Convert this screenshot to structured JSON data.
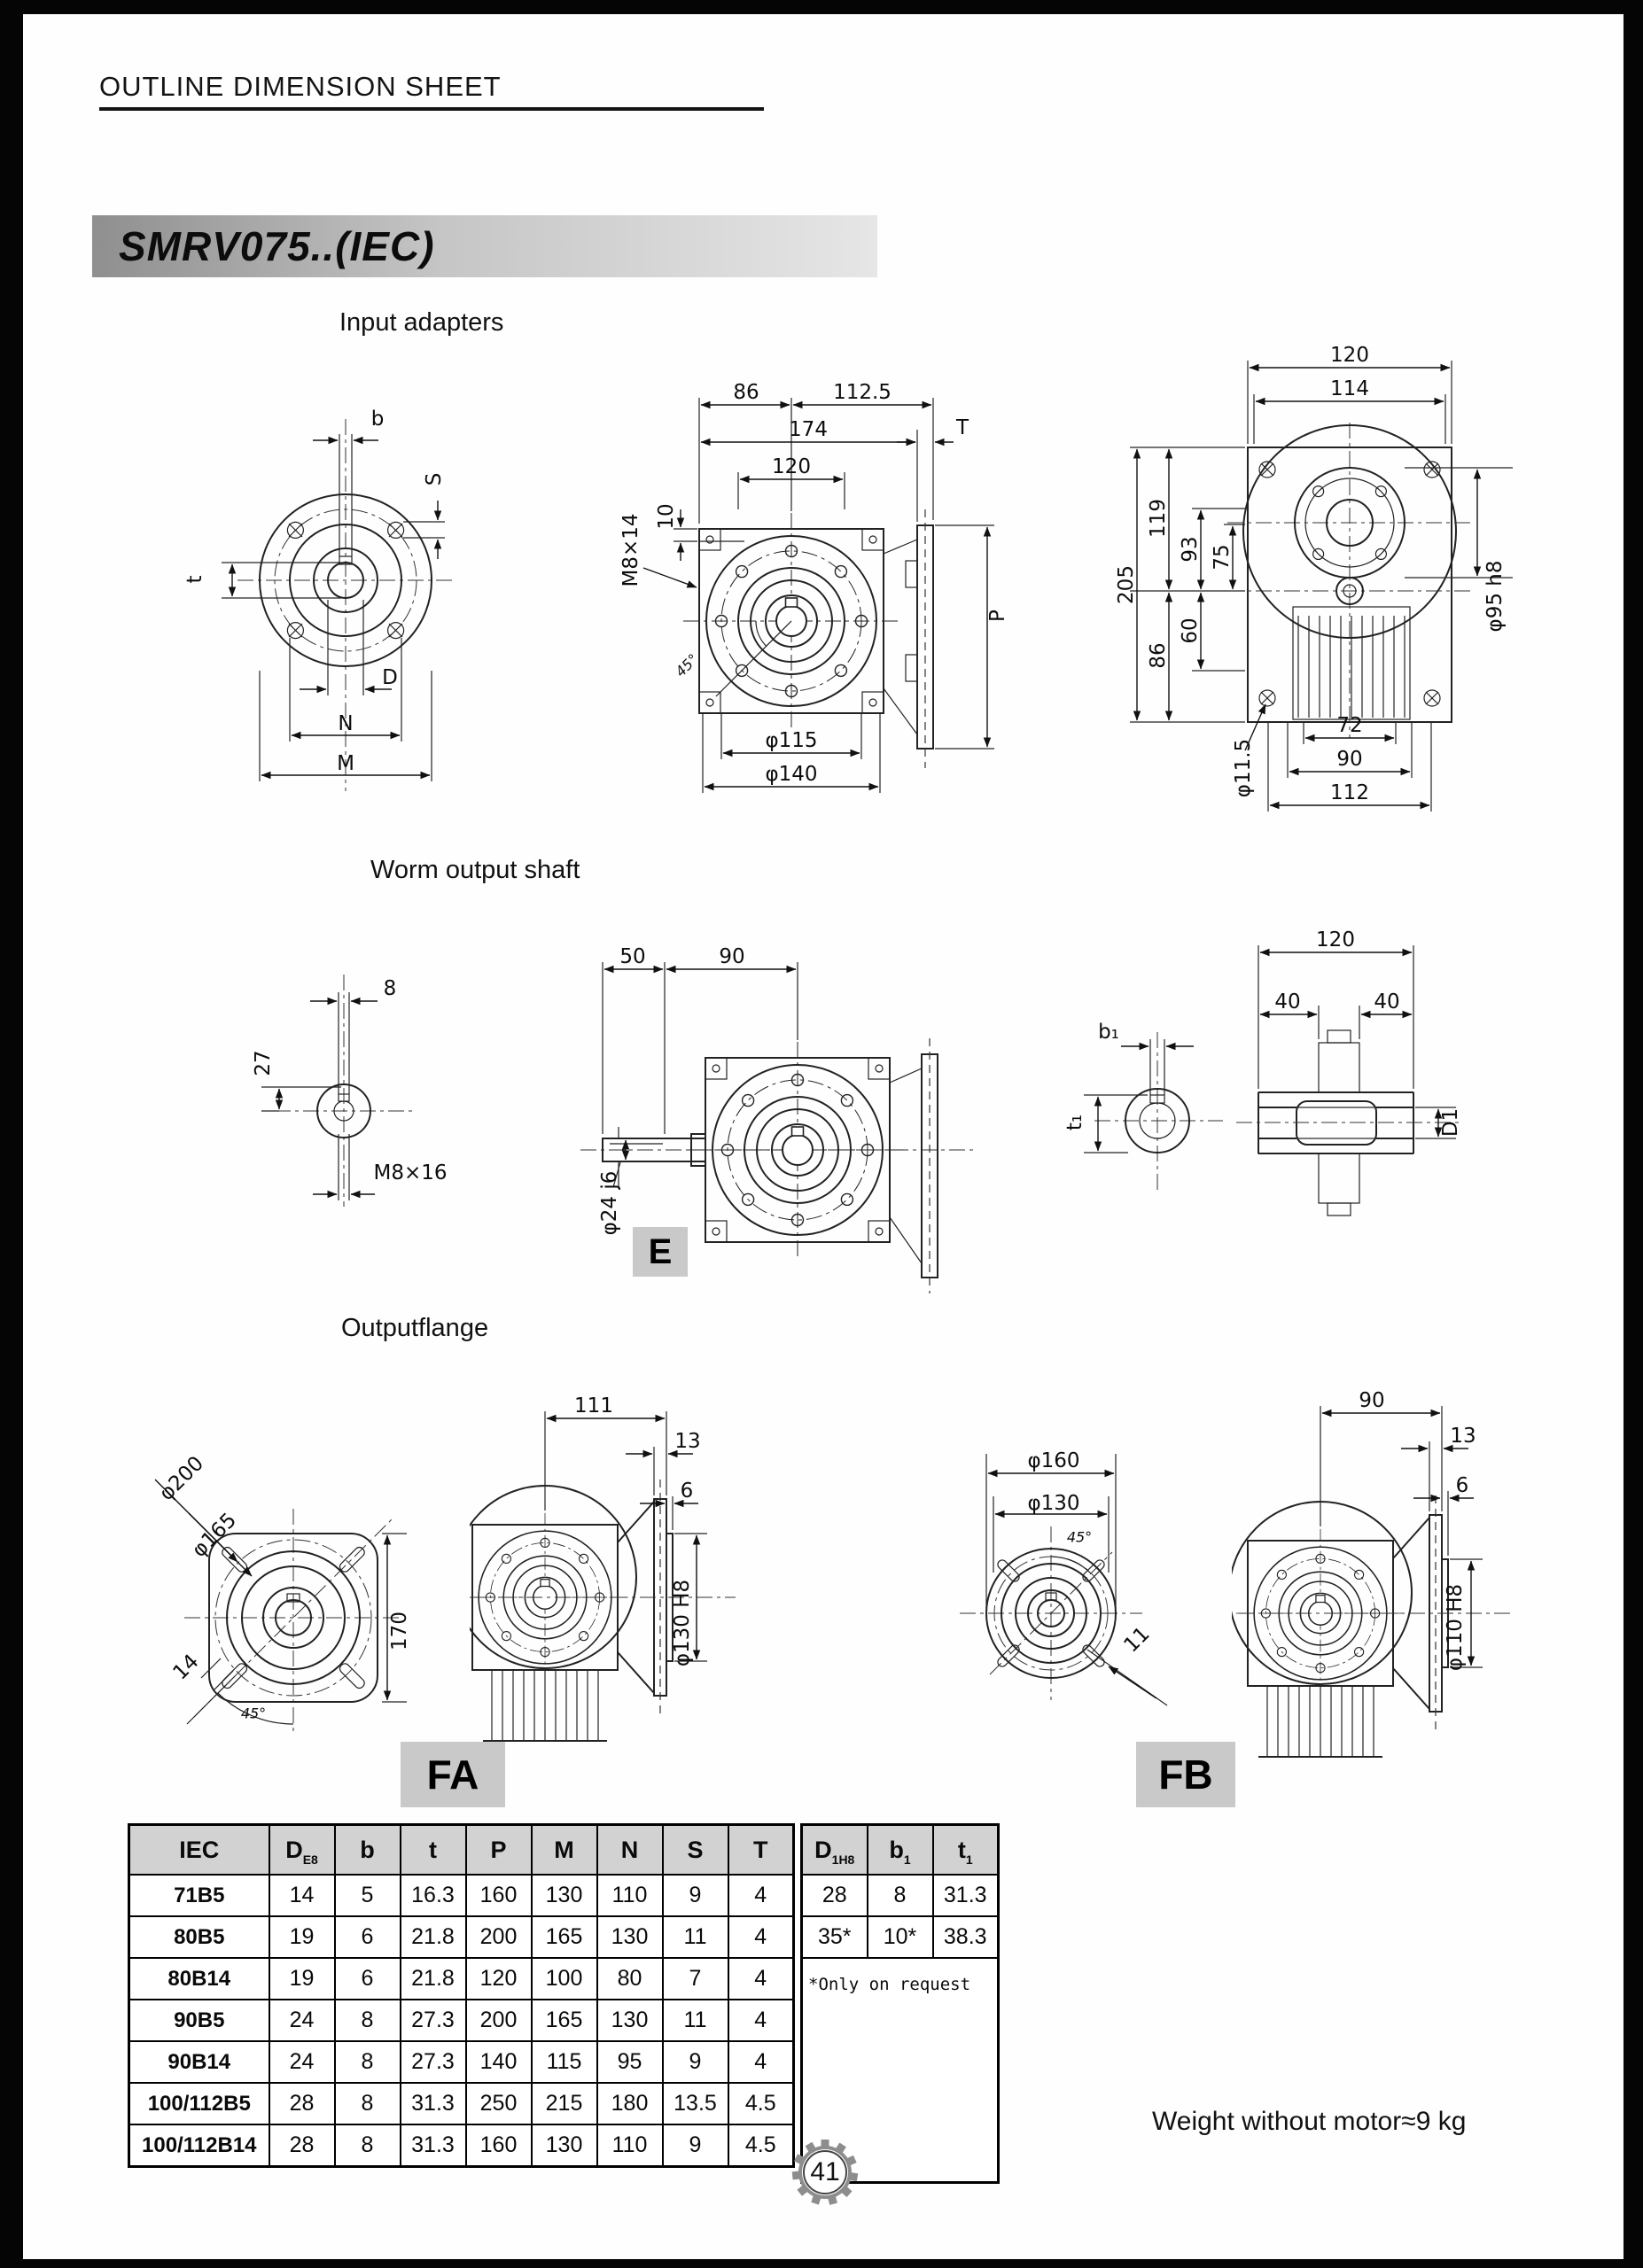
{
  "page": {
    "header": "OUTLINE DIMENSION SHEET",
    "title": "SMRV075..(IEC)",
    "page_number": "41",
    "weight_note": "Weight without motor≈9 kg"
  },
  "colors": {
    "badge_bg": "#c9c9c9",
    "titlebar_left": "#8f8f8f",
    "titlebar_right": "#e6e6e6",
    "table_header_bg": "#d2d2d2"
  },
  "sections": {
    "input_adapters": "Input adapters",
    "worm_output_shaft": "Worm output shaft",
    "output_flange": "Outputflange"
  },
  "badges": {
    "e": "E",
    "fa": "FA",
    "fb": "FB"
  },
  "dims": {
    "ia_front": [
      "b",
      "S",
      "t",
      "D",
      "N",
      "M"
    ],
    "ia_side": [
      "86",
      "112.5",
      "174",
      "T",
      "120",
      "10",
      "M8×14",
      "P",
      "45°",
      "φ115",
      "φ140"
    ],
    "ia_back": [
      "120",
      "114",
      "205",
      "119",
      "93",
      "75",
      "86",
      "60",
      "φ95 h8",
      "φ11.5",
      "72",
      "90",
      "112"
    ],
    "ws_end": [
      "8",
      "27",
      "M8×16"
    ],
    "ws_side": [
      "50",
      "90",
      "φ24 j6"
    ],
    "ws_bush": [
      "b₁",
      "t₁",
      "120",
      "40",
      "40",
      "D1"
    ],
    "fa_front": [
      "φ200",
      "φ165",
      "170",
      "14",
      "45°"
    ],
    "fa_side": [
      "111",
      "13",
      "6",
      "φ130 H8"
    ],
    "fb_front": [
      "φ160",
      "φ130",
      "45°",
      "11"
    ],
    "fb_side": [
      "90",
      "13",
      "6",
      "φ110 H8"
    ]
  },
  "table": {
    "headers": [
      {
        "t": "IEC",
        "s": ""
      },
      {
        "t": "D",
        "s": "E8"
      },
      {
        "t": "b",
        "s": ""
      },
      {
        "t": "t",
        "s": ""
      },
      {
        "t": "P",
        "s": ""
      },
      {
        "t": "M",
        "s": ""
      },
      {
        "t": "N",
        "s": ""
      },
      {
        "t": "S",
        "s": ""
      },
      {
        "t": "T",
        "s": ""
      },
      {
        "t": "D",
        "s": "1H8"
      },
      {
        "t": "b",
        "s": "1"
      },
      {
        "t": "t",
        "s": "1"
      }
    ],
    "rows": [
      [
        "71B5",
        "14",
        "5",
        "16.3",
        "160",
        "130",
        "110",
        "9",
        "4"
      ],
      [
        "80B5",
        "19",
        "6",
        "21.8",
        "200",
        "165",
        "130",
        "11",
        "4"
      ],
      [
        "80B14",
        "19",
        "6",
        "21.8",
        "120",
        "100",
        "80",
        "7",
        "4"
      ],
      [
        "90B5",
        "24",
        "8",
        "27.3",
        "200",
        "165",
        "130",
        "11",
        "4"
      ],
      [
        "90B14",
        "24",
        "8",
        "27.3",
        "140",
        "115",
        "95",
        "9",
        "4"
      ],
      [
        "100/112B5",
        "28",
        "8",
        "31.3",
        "250",
        "215",
        "180",
        "13.5",
        "4.5"
      ],
      [
        "100/112B14",
        "28",
        "8",
        "31.3",
        "160",
        "130",
        "110",
        "9",
        "4.5"
      ]
    ],
    "right_rows": [
      [
        "28",
        "8",
        "31.3"
      ],
      [
        "35*",
        "10*",
        "38.3"
      ]
    ],
    "note": "*Only on request"
  }
}
